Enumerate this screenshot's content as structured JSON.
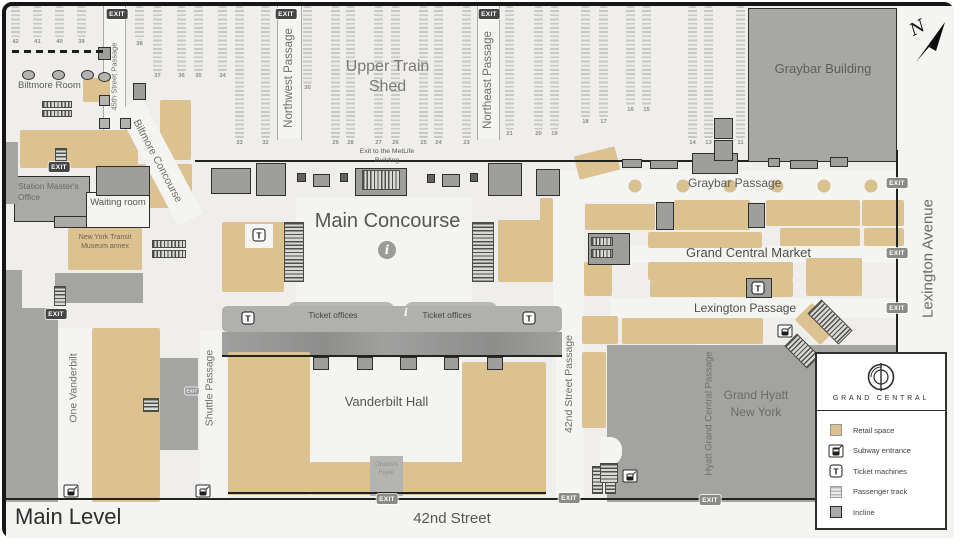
{
  "title": {
    "main_level": "Main Level"
  },
  "streets": {
    "forty_second": "42nd Street",
    "lexington_avenue": "Lexington Avenue",
    "one_vanderbilt": "One Vanderbilt"
  },
  "buildings": {
    "graybar": "Graybar Building",
    "grand_hyatt": "Grand Hyatt New York",
    "metlife_exit": "Exit to the MetLife Building"
  },
  "areas": {
    "upper_train_shed": "Upper Train Shed",
    "main_concourse": "Main Concourse",
    "vanderbilt_hall": "Vanderbilt Hall",
    "biltmore_room": "Biltmore Room",
    "waiting_room": "Waiting room",
    "station_masters_office": "Station Master's Office",
    "transit_museum_annex": "New York Transit Museum annex",
    "onassis_foyer": "Onassis Foyer",
    "ticket_offices": "Ticket offices"
  },
  "passages": {
    "p45th": "45th Street Passage",
    "northwest": "Northwest Passage",
    "northeast": "Northeast Passage",
    "graybar": "Graybar Passage",
    "grand_central_market": "Grand Central Market",
    "lexington": "Lexington Passage",
    "shuttle": "Shuttle Passage",
    "p42nd": "42nd Street Passage",
    "hyatt": "Hyatt Grand Central Passage",
    "biltmore_concourse": "Biltmore Concourse"
  },
  "symbols": {
    "exit": "EXIT",
    "north": "N",
    "info": "i",
    "ticket": "T"
  },
  "tracks": [
    "42",
    "41",
    "40",
    "39",
    "38",
    "37",
    "36",
    "35",
    "34",
    "33",
    "32",
    "30",
    "29",
    "28",
    "27",
    "26",
    "25",
    "24",
    "23",
    "21",
    "20",
    "19",
    "18",
    "17",
    "16",
    "15",
    "14",
    "13",
    "11"
  ],
  "legend": {
    "brand": "GRAND CENTRAL",
    "items": [
      {
        "name": "retail-space",
        "label": "Retail space"
      },
      {
        "name": "subway-entrance",
        "label": "Subway entrance"
      },
      {
        "name": "ticket-machines",
        "label": "Ticket machines"
      },
      {
        "name": "passenger-track",
        "label": "Passenger track"
      },
      {
        "name": "incline",
        "label": "Incline"
      }
    ]
  },
  "colors": {
    "retail": "#dcc291",
    "building": "#a7a7a6",
    "hyatt": "#a3a3a2",
    "floor": "#efeeed"
  }
}
